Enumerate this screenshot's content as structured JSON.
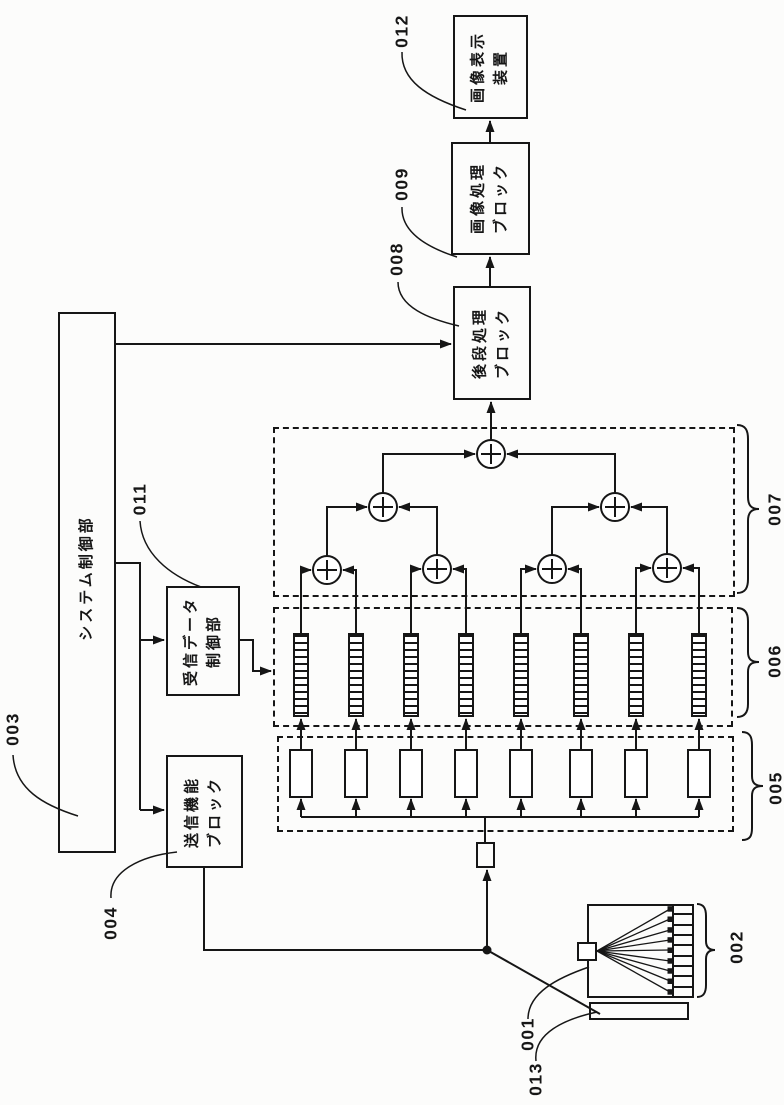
{
  "diagram": {
    "boxes": [
      {
        "id": "image-display-device",
        "label": "画像表示\n装置"
      },
      {
        "id": "image-processing-block",
        "label": "画像処理\nブロック"
      },
      {
        "id": "post-stage-processing-block",
        "label": "後段処理\nブロック"
      },
      {
        "id": "system-control-unit",
        "label": "システム制御部"
      },
      {
        "id": "rx-data-control-unit",
        "label": "受信データ\n制御部"
      },
      {
        "id": "tx-function-block",
        "label": "送信機能\nブロック"
      }
    ],
    "refs": {
      "probe": "001",
      "transducer_array": "002",
      "system_control": "003",
      "tx_function": "004",
      "amplifier_group": "005",
      "delay_line_group": "006",
      "adder_tree_group": "007",
      "post_processing": "008",
      "image_processing": "009",
      "rx_data_control": "011",
      "image_display": "012",
      "subject": "013"
    }
  }
}
